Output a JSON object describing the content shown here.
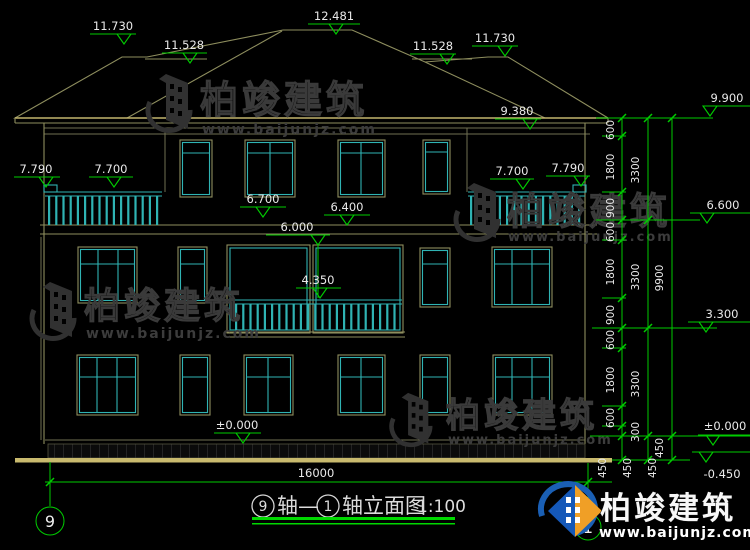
{
  "drawing": {
    "markers": [
      {
        "v": "12.481"
      },
      {
        "v": "11.730"
      },
      {
        "v": "11.528"
      },
      {
        "v": "11.528"
      },
      {
        "v": "11.730"
      },
      {
        "v": "9.900"
      },
      {
        "v": "9.380"
      },
      {
        "v": "7.790"
      },
      {
        "v": "7.700"
      },
      {
        "v": "7.700"
      },
      {
        "v": "7.790"
      },
      {
        "v": "6.700"
      },
      {
        "v": "6.400"
      },
      {
        "v": "6.000"
      },
      {
        "v": "4.350"
      },
      {
        "v": "6.600"
      },
      {
        "v": "3.300"
      },
      {
        "v": "±0.000"
      },
      {
        "v": "±0.000"
      },
      {
        "v": "-0.450"
      }
    ],
    "vdims": [
      {
        "v": "600"
      },
      {
        "v": "1800"
      },
      {
        "v": "900"
      },
      {
        "v": "600"
      },
      {
        "v": "1800"
      },
      {
        "v": "900"
      },
      {
        "v": "600"
      },
      {
        "v": "1800"
      },
      {
        "v": "600"
      },
      {
        "v": "300"
      },
      {
        "v": "450"
      },
      {
        "v": "450"
      },
      {
        "v": "450"
      },
      {
        "v": "450"
      },
      {
        "v": "3300"
      },
      {
        "v": "3300"
      },
      {
        "v": "3300"
      },
      {
        "v": "9900"
      }
    ],
    "hdim": {
      "v": "16000"
    },
    "axes": {
      "left": "9",
      "right": "1"
    },
    "title": {
      "axis_start": "9",
      "mid": "轴—",
      "axis_end": "1",
      "tail": "轴立面图",
      "scale": "1:100"
    }
  },
  "watermark": {
    "name": "柏竣建筑",
    "url": "www.baijunjz.com"
  },
  "brand": {
    "name": "柏竣建筑",
    "url": "www.baijunjz.com"
  }
}
